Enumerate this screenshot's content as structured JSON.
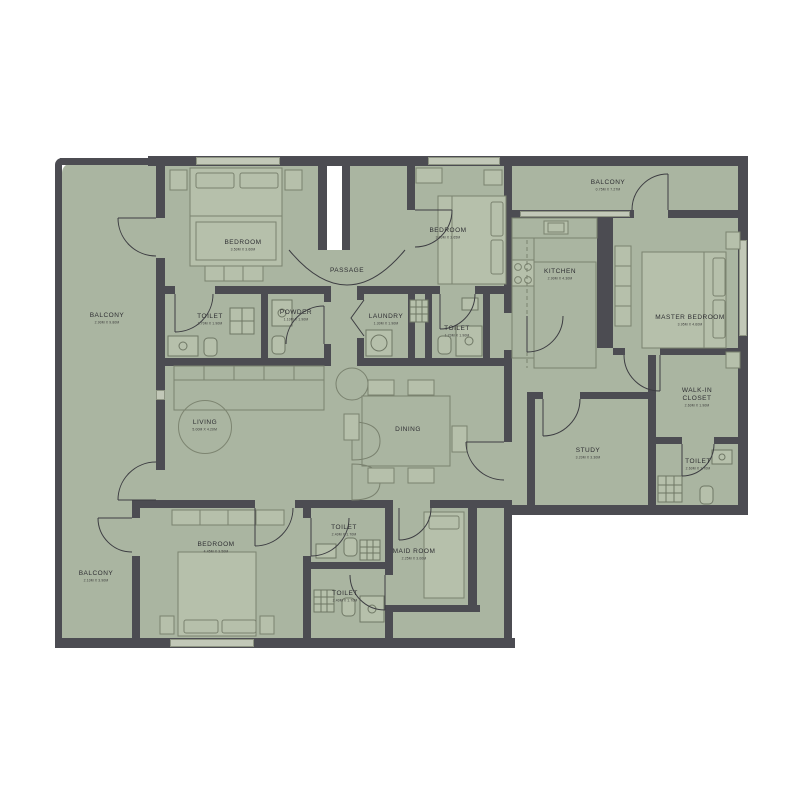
{
  "plan": {
    "type": "apartment-floor-plan",
    "colors": {
      "floor": "#aab5a1",
      "wall": "#4c4c52",
      "furniture_line": "#7a826f",
      "door_line": "#3d3d42",
      "text": "#2f2f33"
    },
    "rooms": [
      {
        "id": "bedroom-1",
        "label": "BEDROOM",
        "dim": "3.50M X 3.60M",
        "x": 243,
        "y": 247
      },
      {
        "id": "bedroom-2",
        "label": "BEDROOM",
        "dim": "3.00M X 3.65M",
        "x": 448,
        "y": 235
      },
      {
        "id": "passage",
        "label": "PASSAGE",
        "x": 347,
        "y": 271
      },
      {
        "id": "toilet-1",
        "label": "TOILET",
        "dim": "1.70M X 1.90M",
        "x": 210,
        "y": 321
      },
      {
        "id": "powder",
        "label": "POWDER",
        "dim": "1.10M X 1.90M",
        "x": 296,
        "y": 317
      },
      {
        "id": "laundry",
        "label": "LAUNDRY",
        "dim": "1.30M X 1.90M",
        "x": 386,
        "y": 321
      },
      {
        "id": "toilet-2",
        "label": "TOILET",
        "dim": "1.70M X 1.90M",
        "x": 457,
        "y": 333
      },
      {
        "id": "balcony-left",
        "label": "BALCONY",
        "dim": "2.90M X 9.80M",
        "x": 107,
        "y": 320
      },
      {
        "id": "balcony-top",
        "label": "BALCONY",
        "dim": "0.75M X 7.27M",
        "x": 608,
        "y": 187
      },
      {
        "id": "kitchen",
        "label": "KITCHEN",
        "dim": "2.90M X 4.30M",
        "x": 560,
        "y": 276
      },
      {
        "id": "master-bedroom",
        "label": "MASTER BEDROOM",
        "dim": "3.95M X 4.60M",
        "x": 690,
        "y": 322
      },
      {
        "id": "walk-in-closet",
        "label": "WALK-IN CLOSET",
        "dim": "2.60M X 1.90M",
        "x": 697,
        "y": 399,
        "w": 46
      },
      {
        "id": "toilet-master",
        "label": "TOILET",
        "dim": "2.60M X 1.70M",
        "x": 698,
        "y": 466
      },
      {
        "id": "study",
        "label": "STUDY",
        "dim": "3.20M X 3.30M",
        "x": 588,
        "y": 455
      },
      {
        "id": "living",
        "label": "LIVING",
        "dim": "5.00M X 4.20M",
        "x": 205,
        "y": 427,
        "circle": true
      },
      {
        "id": "dining",
        "label": "DINING",
        "x": 408,
        "y": 430
      },
      {
        "id": "bedroom-3",
        "label": "BEDROOM",
        "dim": "4.45M X 3.50M",
        "x": 216,
        "y": 549
      },
      {
        "id": "toilet-3",
        "label": "TOILET",
        "dim": "2.40M X 1.70M",
        "x": 344,
        "y": 532
      },
      {
        "id": "toilet-4",
        "label": "TOILET",
        "dim": "2.40M X 1.70M",
        "x": 345,
        "y": 598
      },
      {
        "id": "maid-room",
        "label": "MAID ROOM",
        "dim": "2.25M X 3.00M",
        "x": 414,
        "y": 556
      },
      {
        "id": "balcony-bottom",
        "label": "BALCONY",
        "dim": "2.10M X 3.90M",
        "x": 96,
        "y": 578
      }
    ]
  }
}
